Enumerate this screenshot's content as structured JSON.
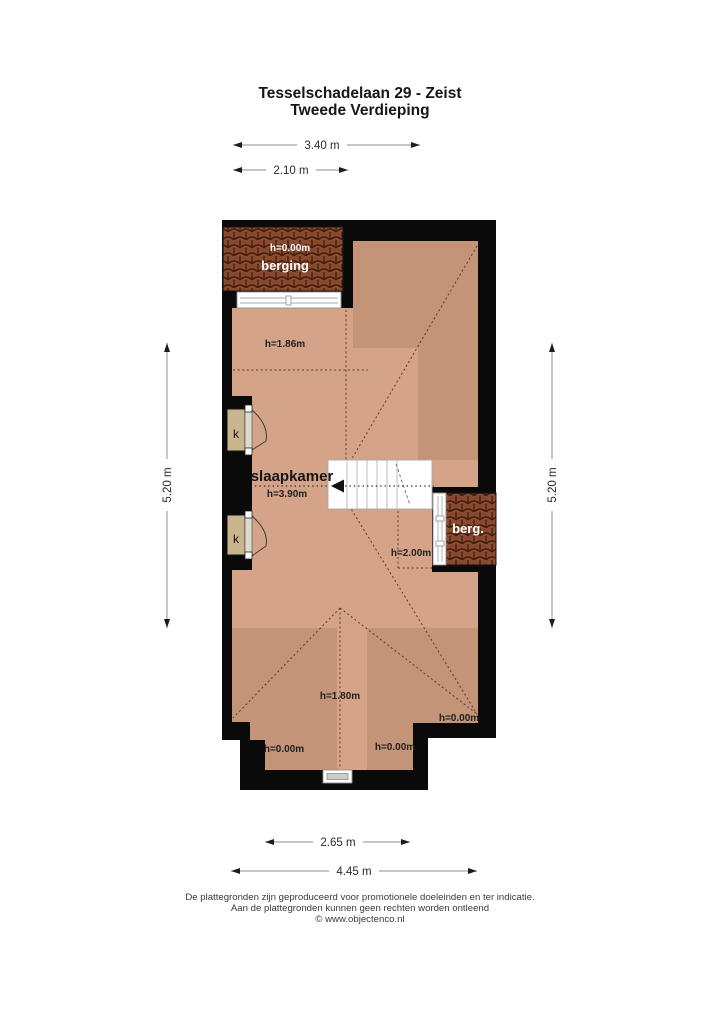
{
  "title": {
    "line1": "Tesselschadelaan 29 - Zeist",
    "line2": "Tweede Verdieping"
  },
  "dimensions": {
    "top_outer": "3.40 m",
    "top_inner": "2.10 m",
    "left": "5.20 m",
    "right": "5.20 m",
    "bottom_inner": "2.65 m",
    "bottom_outer": "4.45 m"
  },
  "rooms": {
    "berging": {
      "name": "berging",
      "height": "h=0.00m"
    },
    "slaapkamer": {
      "name": "slaapkamer",
      "height": "h=3.90m"
    },
    "berg": {
      "name": "berg."
    },
    "closet_label": "k"
  },
  "annotations": {
    "h186": "h=1.86m",
    "h200": "h=2.00m",
    "h180": "h=1.80m",
    "h000": "h=0.00m"
  },
  "footer": {
    "line1": "De plattegronden zijn geproduceerd voor promotionele doeleinden en ter indicatie.",
    "line2": "Aan de plattegronden kunnen geen rechten worden ontleend",
    "line3": "© www.objectenco.nl"
  },
  "colors": {
    "floor_light": "#d5a488",
    "floor_dark": "#c49479",
    "wall": "#0a0a0a",
    "tile_base": "#8a4a2f",
    "tile_line": "#431e0f",
    "closet": "#c9b58e"
  }
}
